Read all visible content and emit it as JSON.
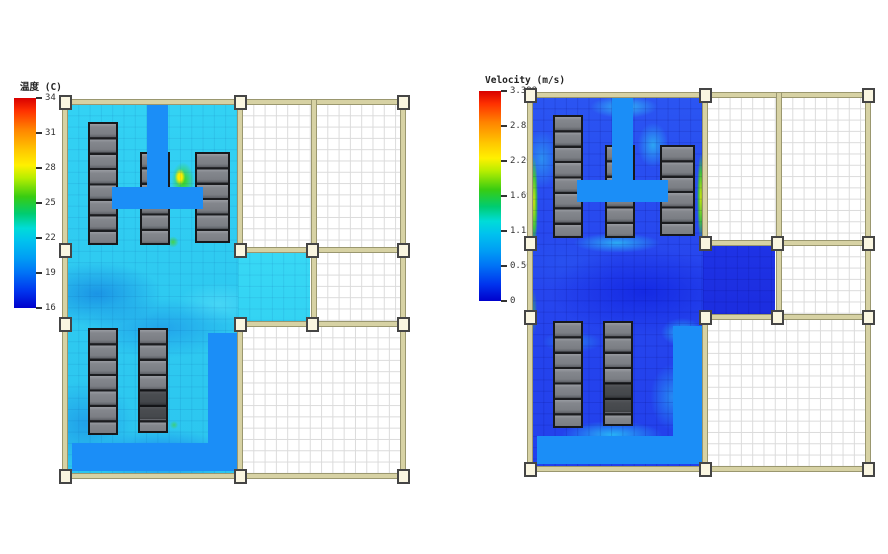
{
  "page": {
    "background": "#ffffff",
    "width": 888,
    "height": 554,
    "description": "CFD simulation results of a data-center floor plan: left panel temperature contour, right panel velocity contour"
  },
  "panels": [
    {
      "id": "temperature",
      "legend": {
        "title": "温度 (C)",
        "ticks": [
          "34",
          "31",
          "28",
          "25",
          "22",
          "19",
          "16"
        ]
      }
    },
    {
      "id": "velocity",
      "legend": {
        "title": "Velocity (m/s)",
        "ticks": [
          "3.398",
          "2.831",
          "2.265",
          "1.699",
          "1.133",
          "0.566",
          "0"
        ]
      }
    }
  ],
  "chart_data": [
    {
      "type": "heatmap",
      "title": "温度 (C)",
      "colormap": "jet",
      "colorbar_ticks": [
        34,
        31,
        28,
        25,
        22,
        19,
        16
      ],
      "value_range": [
        16,
        34
      ],
      "units": "C",
      "legend_position": "left",
      "dominant_field_value_range": [
        18,
        23
      ],
      "hotspot": {
        "approx_value": 28,
        "location": "between middle and right rack rows, top hall"
      },
      "notes": "Floor plan contour; simulated hall mostly cyan (~20-22 C); supply ducts drawn dodger blue; unsimulated rooms white with grid"
    },
    {
      "type": "heatmap",
      "title": "Velocity (m/s)",
      "colormap": "jet",
      "colorbar_ticks": [
        3.398,
        2.831,
        2.265,
        1.699,
        1.133,
        0.566,
        0
      ],
      "value_range": [
        0,
        3.398
      ],
      "units": "m/s",
      "legend_position": "left",
      "dominant_field_value_range": [
        0.2,
        0.9
      ],
      "hotspot": {
        "approx_value": 2.0,
        "location": "thin green-yellow jets along left and right walls of top hall"
      },
      "notes": "Same floor plan; field mostly deep blue (low velocity) with cyan swirls; corridor stub dark blue"
    }
  ],
  "scene": {
    "rack_rows_top_hall": 3,
    "rack_rows_bottom_hall": 2,
    "racks_per_row": [
      8,
      6,
      6,
      7,
      7
    ],
    "colors": {
      "wall_tan": "#d7d2a4",
      "wall_outline": "#9a976f",
      "column_marker": "#faf6e1",
      "rack_grey": "#84878d",
      "rack_dark": "#3d3f43",
      "duct_blue": "#1b8ef7",
      "temp_base_cyan": "#30ccf1",
      "velocity_base_blue": "#2644ee",
      "room_grid": "#dbdbdb"
    }
  }
}
